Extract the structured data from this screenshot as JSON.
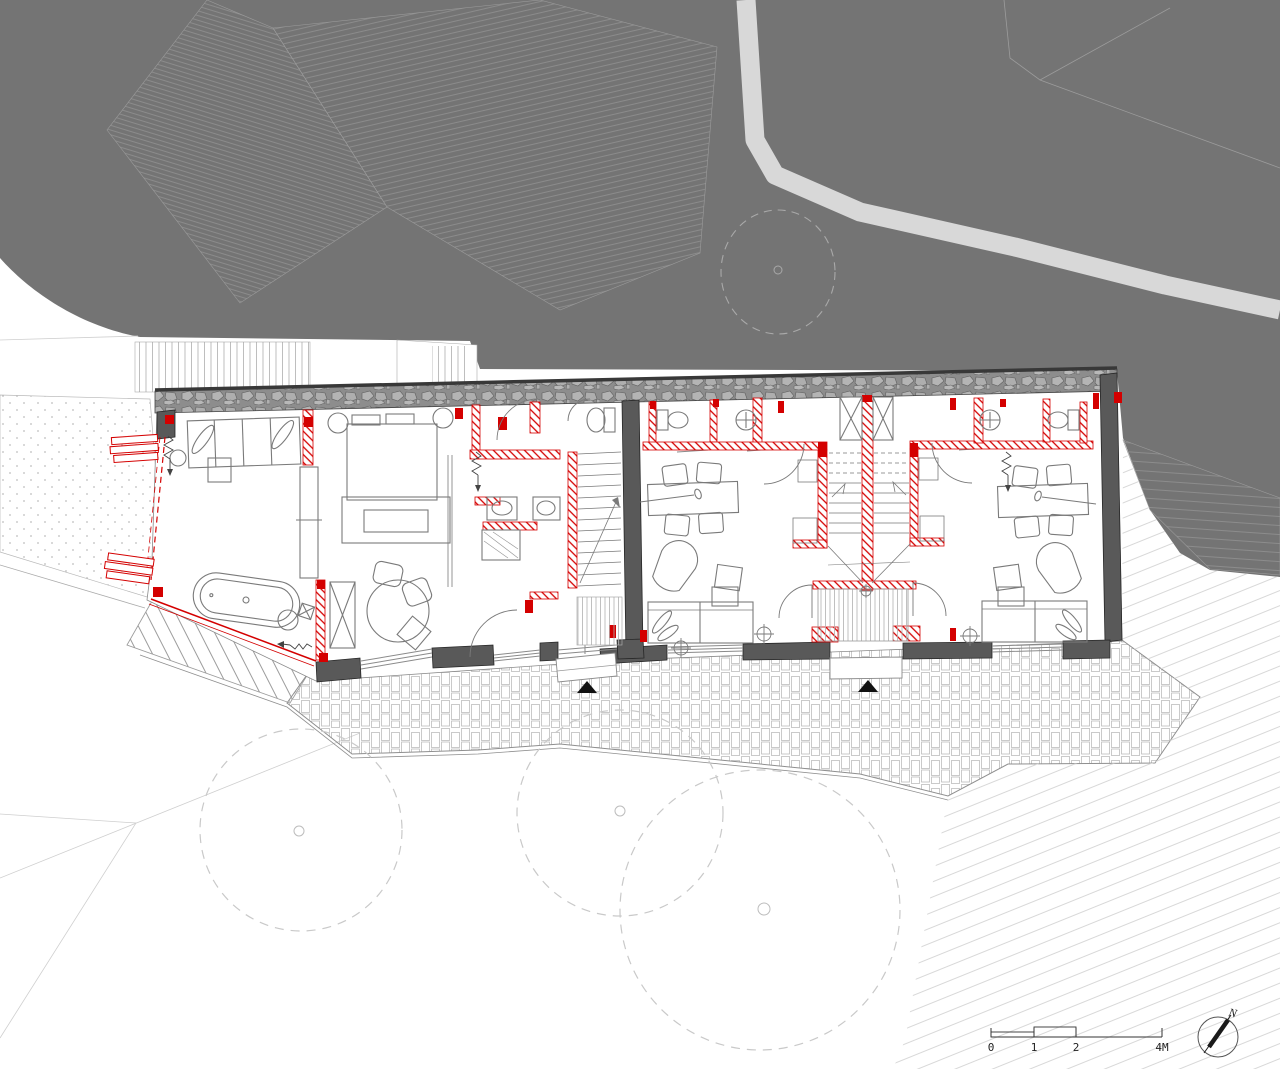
{
  "drawing": {
    "type": "architectural ground floor plan with site context",
    "scale_bar": {
      "labels": [
        "0",
        "1",
        "2",
        "4M"
      ]
    },
    "north_arrow": {
      "label": "N"
    }
  },
  "icons": {
    "entrance-arrow": "filled triangle pointing up at building entries",
    "north-arrow": "thin circle with diagonal needle",
    "tree": "dashed circle with small center dot",
    "shaft": "rectangle with X diagonals",
    "spring-symbol": "small zigzag with arrow"
  },
  "colors": {
    "background": "#ffffff",
    "terrain": "#747474",
    "terrain_hatch": "#989898",
    "road": "#d8d8d8",
    "existing_wall": "#595959",
    "stone_band": "#8d8d8d",
    "stone_fill": "#b4b4b4",
    "new_wall_red": "#d40000",
    "furniture_line": "#7a7a7a",
    "paving_line": "#bdbdbd",
    "tree_line": "#c9c9c9",
    "faint_line": "#d8d8d8"
  }
}
